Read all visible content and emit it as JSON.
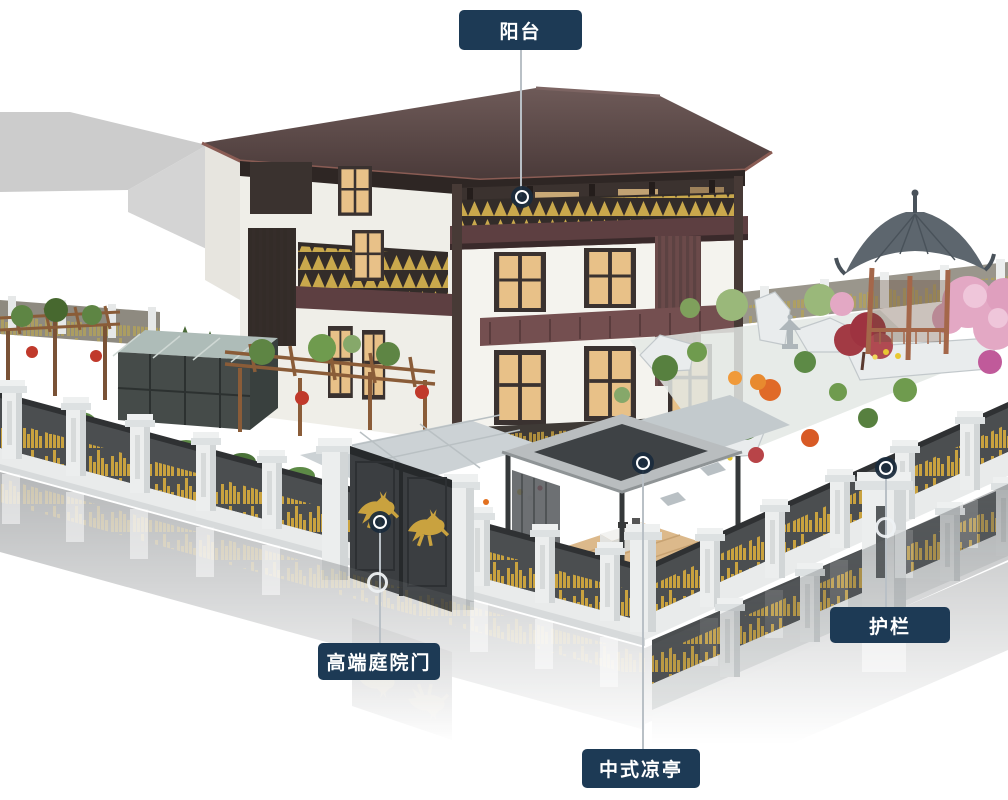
{
  "scene_title": "",
  "callouts": [
    {
      "id": "balcony",
      "label": "阳台"
    },
    {
      "id": "courtyard-gate",
      "label": "高端庭院门"
    },
    {
      "id": "pavilion",
      "label": "中式凉亭"
    },
    {
      "id": "guardrail",
      "label": "护栏"
    }
  ],
  "colors": {
    "label_background": "#1d3a55",
    "label_text": "#ffffff",
    "callout_line": "#b9c0c6",
    "marker_fill": "#1a2b3c",
    "marker_ring": "#ffffff",
    "roof": "#5a4644",
    "wall": "#f1f0ea",
    "fence_panel": "#4b4e50",
    "fence_gold": "#c9a23f",
    "gazebo_roof": "#5d666e",
    "gazebo_wood": "#a4674a",
    "blossom": "#e3a8c4",
    "deck_wood": "#dcb98b"
  }
}
